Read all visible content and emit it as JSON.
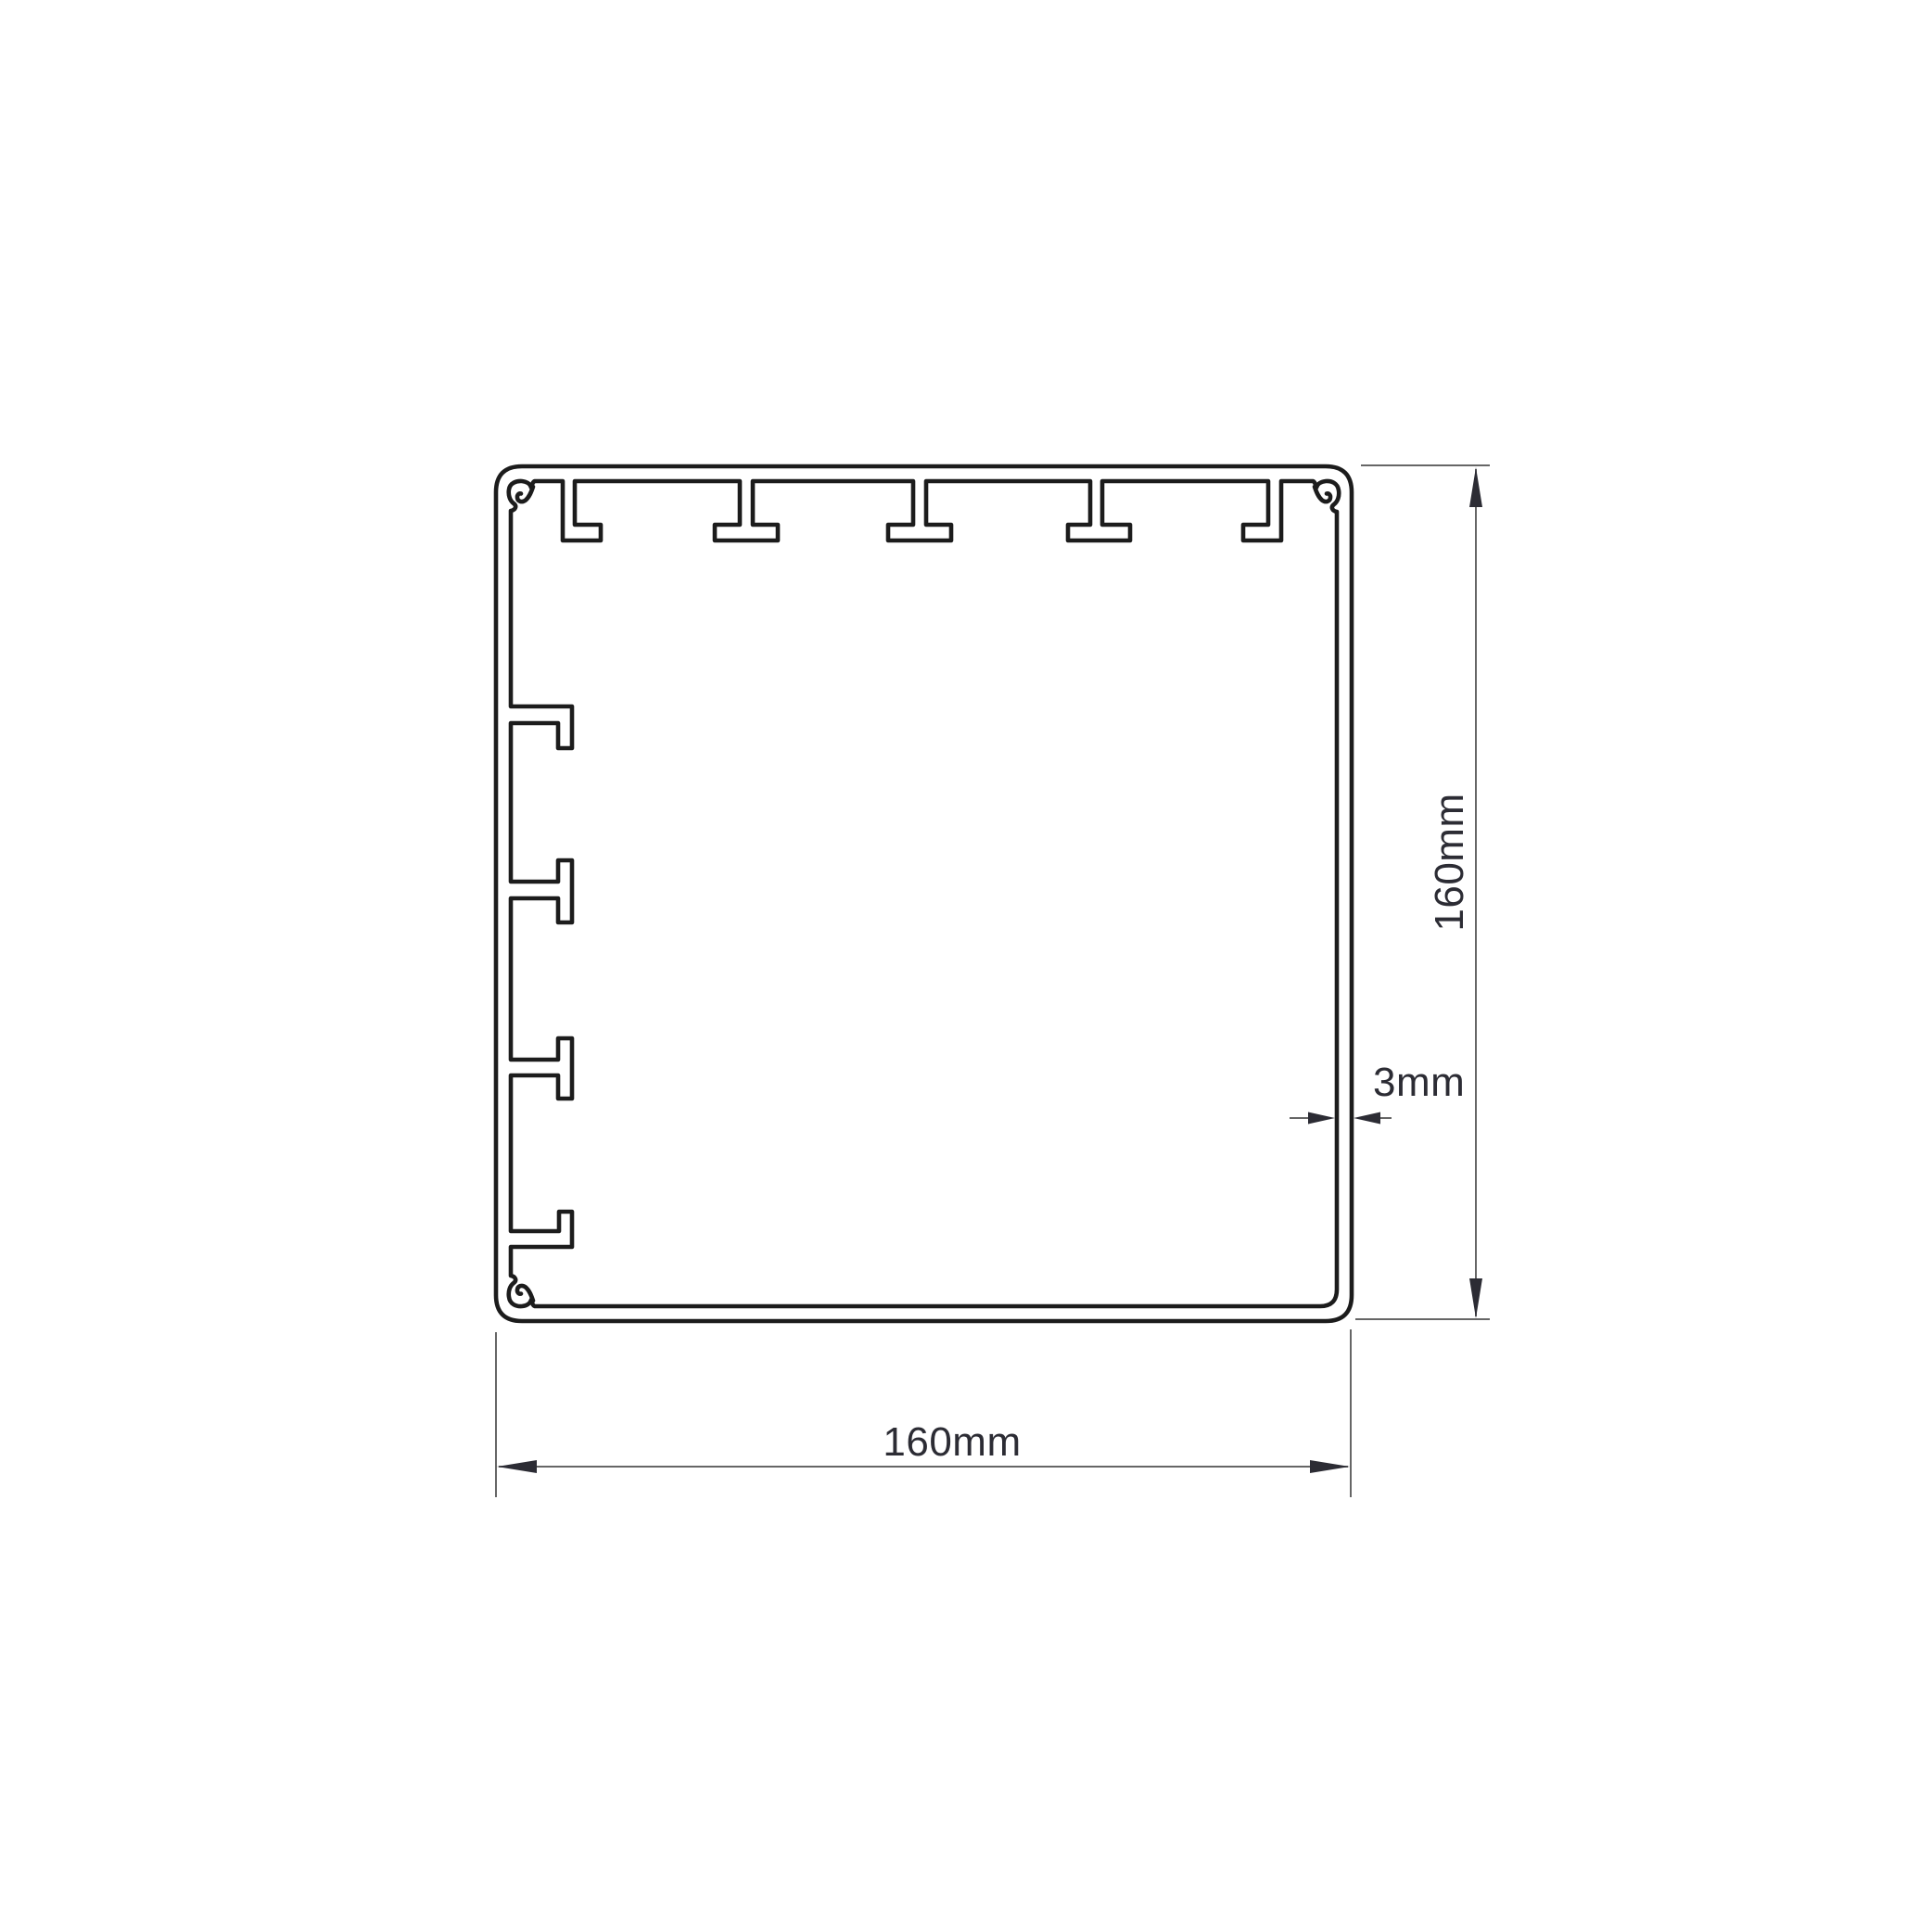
{
  "drawing": {
    "type": "technical-cross-section",
    "description": "Square extrusion profile cross-section with internal ribs, corner screw bosses and dimension callouts",
    "labels": {
      "height": "160mm",
      "width": "160mm",
      "wall_thickness": "3mm"
    },
    "colors": {
      "profile_line": "#1c1c1c",
      "dimension_line": "#666666",
      "text": "#2c2c34",
      "background": "#ffffff"
    }
  }
}
